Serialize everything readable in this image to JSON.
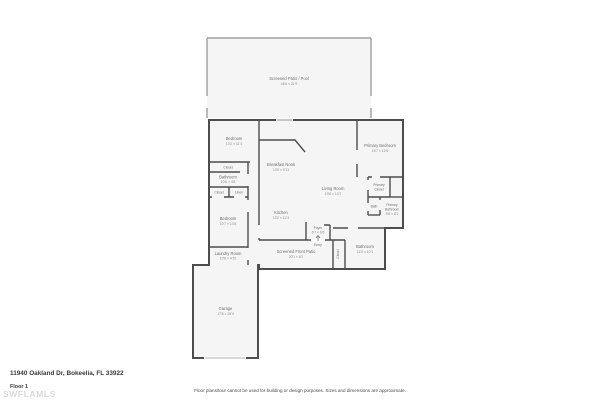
{
  "footer": {
    "address": "11940 Oakland Dr, Bokeelia, FL 33922",
    "floor_label": "Floor 1",
    "watermark": "SWFLAMLS",
    "disclaimer": "Floor plans/tour cannot be used for building or design purposes. Sizes and dimensions are approximate."
  },
  "colors": {
    "wall": "#4d4d4d",
    "patio_wall": "#8f8f8f",
    "room_fill": "#f5f5f5",
    "label_text": "#6e6e6e",
    "background": "#ffffff"
  },
  "rooms": {
    "patio_pool": {
      "label": "Screened Patio / Pool",
      "dims": "44'6 × 21'9"
    },
    "bedroom_top": {
      "label": "Bedroom",
      "dims": "13'2 × 11'4"
    },
    "closet_top": {
      "label": "Closet"
    },
    "bathroom_left": {
      "label": "Bathroom",
      "dims": "10'6 × 4'8"
    },
    "closet_small": {
      "label": "Closet"
    },
    "linen": {
      "label": "Linen"
    },
    "bedroom_mid": {
      "label": "Bedroom",
      "dims": "10'7 × 13'6"
    },
    "laundry": {
      "label": "Laundry Room",
      "dims": "10'6 × 4'10"
    },
    "garage": {
      "label": "Garage",
      "dims": "17'8 × 25'4"
    },
    "breakfast_nook": {
      "label": "Breakfast Nook",
      "dims": "13'9 × 9'11"
    },
    "kitchen": {
      "label": "Kitchen",
      "dims": "13'2 × 12'4"
    },
    "living_room": {
      "label": "Living Room",
      "dims": "19'8 × 14'7"
    },
    "primary_bedroom": {
      "label": "Primary Bedroom",
      "dims": "15'7 × 12'6"
    },
    "primary_closet": {
      "label": "Primary",
      "label2": "Closet"
    },
    "bath": {
      "label": "Bath"
    },
    "primary_bathroom": {
      "label": "Primary",
      "label2": "Bathroom",
      "dims": "9'6 × 8'2"
    },
    "foyer": {
      "label": "Foyer",
      "dims": "6'7 × 6'6"
    },
    "entry": {
      "label": "Entry"
    },
    "front_patio": {
      "label": "Screened Front Patio",
      "dims": "20'1 × 8'2"
    },
    "bathroom_right": {
      "label": "Bathroom",
      "dims": "11'5 × 10'1"
    },
    "closet_vertical": {
      "label": "Closet"
    }
  }
}
